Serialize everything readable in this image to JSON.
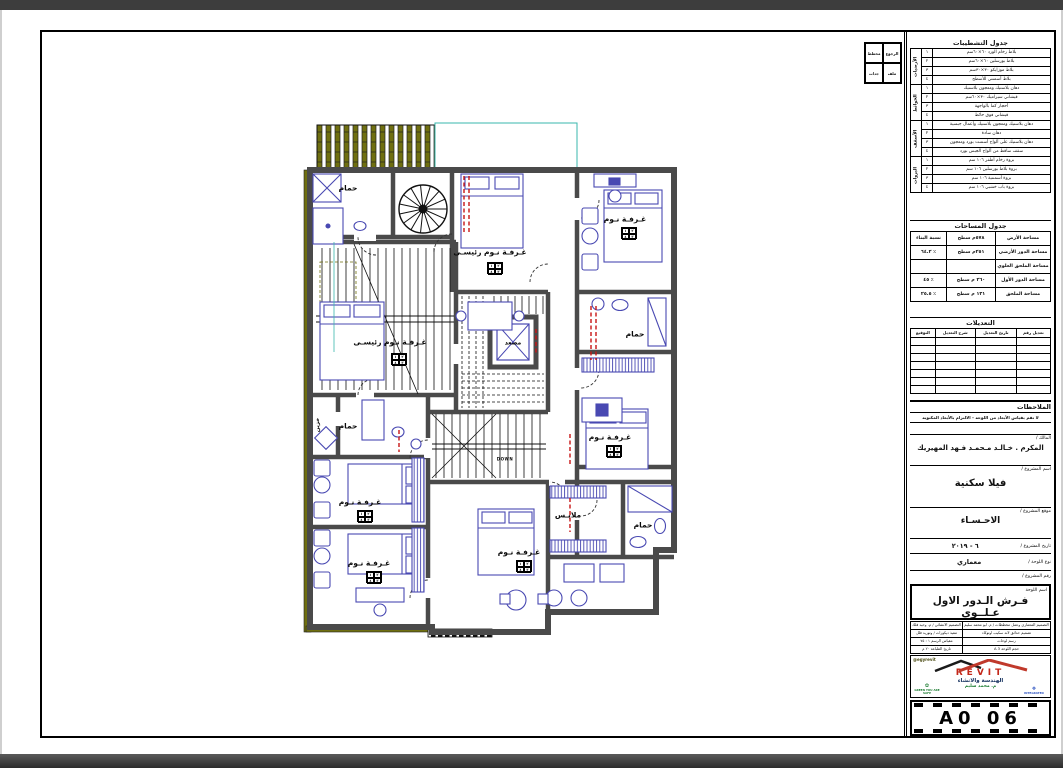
{
  "corner_box": {
    "cells": [
      "الرجوع",
      "مخطط",
      "ملف",
      "جدات"
    ]
  },
  "titleblock": {
    "finishes": {
      "title": "جدول التشطيبات",
      "groups": [
        {
          "name": "الأرضيات",
          "rows": [
            {
              "num": "١",
              "desc": "بلاط رخام الورد ٦٠×٦٠سم"
            },
            {
              "num": "٢",
              "desc": "بلاط بورسلين ٦٠×٦٠سم"
            },
            {
              "num": "٣",
              "desc": "بلاط موزايكو ٣٠×٣٠سم"
            },
            {
              "num": "٤",
              "desc": "بلاط أسمنتي للأسطح"
            }
          ]
        },
        {
          "name": "الحوائط",
          "rows": [
            {
              "num": "١",
              "desc": "دهان بلاستيك ومعجون بلاستيك"
            },
            {
              "num": "٢",
              "desc": "قيشاني سيراميك ٣٠×٦٠سم"
            },
            {
              "num": "٣",
              "desc": "أحجار كما بالواجهة"
            },
            {
              "num": "٤",
              "desc": "قيشاني فوق حائط"
            }
          ]
        },
        {
          "name": "الأسقف",
          "rows": [
            {
              "num": "١",
              "desc": "دهان بلاستيك ومعجون بلاستيك وأعمال جبسية"
            },
            {
              "num": "٢",
              "desc": "دهان سادة"
            },
            {
              "num": "٣",
              "desc": "دهان بلاستيك على ألواح أسمنت بورد ومعجون"
            },
            {
              "num": "٤",
              "desc": "سقف ساقط من ألواح الجبس بورد"
            }
          ]
        },
        {
          "name": "البروات",
          "rows": [
            {
              "num": "١",
              "desc": "بروة رخام أظفر ١٠٦ سم"
            },
            {
              "num": "٢",
              "desc": "بروة بلاط بورسلين ١٠٦ سم"
            },
            {
              "num": "٣",
              "desc": "بروة أسمنتية ١٠٦ سم"
            },
            {
              "num": "٤",
              "desc": "بروة باب خشبي ١٠٦ سم"
            }
          ]
        }
      ]
    },
    "areas": {
      "title": "جدول المساحات",
      "rows": [
        {
          "label": "مساحة الأرض",
          "value": "٥٧٨م سطح",
          "ratio": "نسبة البناء"
        },
        {
          "label": "مساحة الدور الأرضي",
          "value": "٢٥١م سطح",
          "ratio": "٪ ٦٤.٢"
        },
        {
          "label": "مساحة الملحق العلوي",
          "value": "",
          "ratio": ""
        },
        {
          "label": "مساحة الدور الأول",
          "value": "٢٦٠ م سطح",
          "ratio": "٪ ٤٥"
        },
        {
          "label": "مساحة الملحق",
          "value": "١٣١ م سطح",
          "ratio": "٪ ٢٥.٥"
        }
      ]
    },
    "revisions": {
      "title": "التعديلات",
      "headers": [
        "تعديل رقم",
        "تاريخ التعديل",
        "شرح التعديل",
        "التوقيع"
      ],
      "empty_rows": 7
    },
    "notes": {
      "title": "الملاحظات",
      "note": "لا تقم بقياس الأبعاد من اللوحة - الالتزام بالأبعاد المكتوبة"
    },
    "owner": {
      "label": "المالك /",
      "value": "المكرم . خـالـد مـحمـد فـهد المهيريك"
    },
    "project": {
      "label": "اسم المشروع /",
      "value": "فيلا سكنية"
    },
    "location": {
      "label": "موقع المشروع /",
      "value": "الاحـسـاء"
    },
    "date": {
      "label": "تاريخ المشروع /",
      "value": "٦ - ٢٠١٩"
    },
    "sheet_type": {
      "label": "نوع اللوحة /",
      "value": "معماري"
    },
    "project_no": {
      "label": "رقم المشروع /",
      "value": ""
    },
    "sheet_name": {
      "label": "اسم اللوحة",
      "value": "فـرش الـدور الاول عـلــوى"
    },
    "credits": {
      "rows": [
        [
          "التصميم المعماري وعمل مخططات / م. ابو محمد سليم",
          "التصميم الانشائي / م. وحيد فلك"
        ],
        [
          "تصميم حدائق لاند سكيب اوتوكاد",
          "تنفيذ ديكورات / وتوريد فلل"
        ],
        [
          "رسم لوحات",
          "مقياس الرسم ١ : ٧٥"
        ],
        [
          "حجم اللوحة A 3",
          "تاريخ الطباعة ٢٠ م"
        ]
      ]
    },
    "logo": {
      "handle": "@egyrevit",
      "brand": "REVIT",
      "subtitle": "الهندسة والانشاء",
      "engineer": "م. محمد سليم",
      "badge_left": "GREEN YOU ARE SAFE",
      "badge_right": "INTEGRATED"
    },
    "sheet_number": "A0 06"
  },
  "plan": {
    "down_label": "DOWN",
    "tag": [
      "١",
      "٢",
      "٤",
      "٣"
    ],
    "rooms": [
      {
        "label": "حمام"
      },
      {
        "label": "غـرفـة نـوم رئيسـى"
      },
      {
        "label": "غـرفـة نـوم"
      },
      {
        "label": "غـرفـة نـوم رئيسـى"
      },
      {
        "label": "مصعد"
      },
      {
        "label": "حمام"
      },
      {
        "label": "غـرفـة نـوم"
      },
      {
        "label": "حمام"
      },
      {
        "label": "خزين"
      },
      {
        "label": "غـرفـة نـوم"
      },
      {
        "label": "غـرفـة نـوم"
      },
      {
        "label": "غـرفـة نـوم"
      },
      {
        "label": "ملابـس"
      },
      {
        "label": "حمام"
      }
    ],
    "colors": {
      "wall": "#4a4a4a",
      "furniture": "#4949b2",
      "shading": "#6f6f10",
      "terrace": "#3ab7ae",
      "section": "#c81414"
    }
  }
}
